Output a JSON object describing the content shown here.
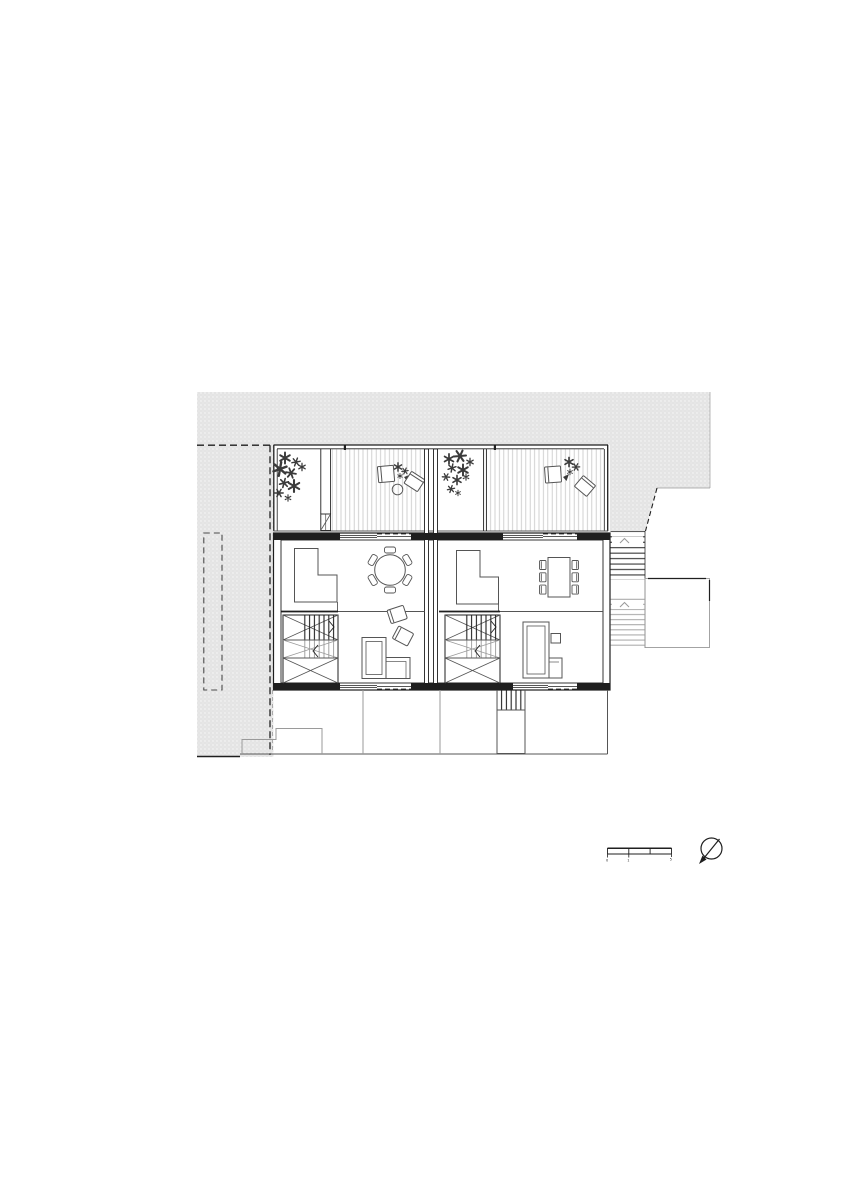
{
  "palette": {
    "background": "#ffffff",
    "site_fill": "#e4e4e4",
    "site_dot": "#f9f9f9",
    "ink": "#1f1f1f",
    "mid": "#555555",
    "light": "#9a9a9a",
    "deck": "#c7c7c7",
    "plant": "#3a3a3a",
    "boundary": "#444444"
  },
  "scale_bar": {
    "labels": [
      "0",
      "1",
      "5"
    ],
    "segments": 3
  },
  "symbols": {
    "north_arrow": "north-arrow",
    "plant": "shrub-asterisk",
    "stair_direction": "up-chevron"
  },
  "drawing": {
    "type": "architectural floor plan, two attached dwelling units",
    "site": {
      "texture": "dot-stipple",
      "boundaries": [
        "dashed-property-line",
        "dashed-setback-rectangle"
      ]
    },
    "units": [
      {
        "name": "unit-a",
        "terrace": [
          "planting-bed",
          "privacy-screen-with-gate",
          "timber-decking",
          "lounge-chair",
          "lounge-chair",
          "round-side-table",
          "potted-plant"
        ],
        "interior": [
          "kitchen-counter",
          "round-dining-table",
          "six-dining-chairs",
          "two-armchairs",
          "corner-sofa",
          "dog-leg-stair"
        ]
      },
      {
        "name": "unit-b",
        "terrace": [
          "planting-bed",
          "privacy-screen",
          "timber-decking",
          "lounge-chair",
          "lounge-chair",
          "potted-plant"
        ],
        "interior": [
          "kitchen-counter",
          "rectangular-dining-table",
          "six-dining-chairs",
          "corner-sofa",
          "side-table",
          "dog-leg-stair"
        ]
      }
    ],
    "exterior": [
      "two-flight-external-stair",
      "landing-platform",
      "lower-level-footprint",
      "lower-external-stair"
    ]
  }
}
